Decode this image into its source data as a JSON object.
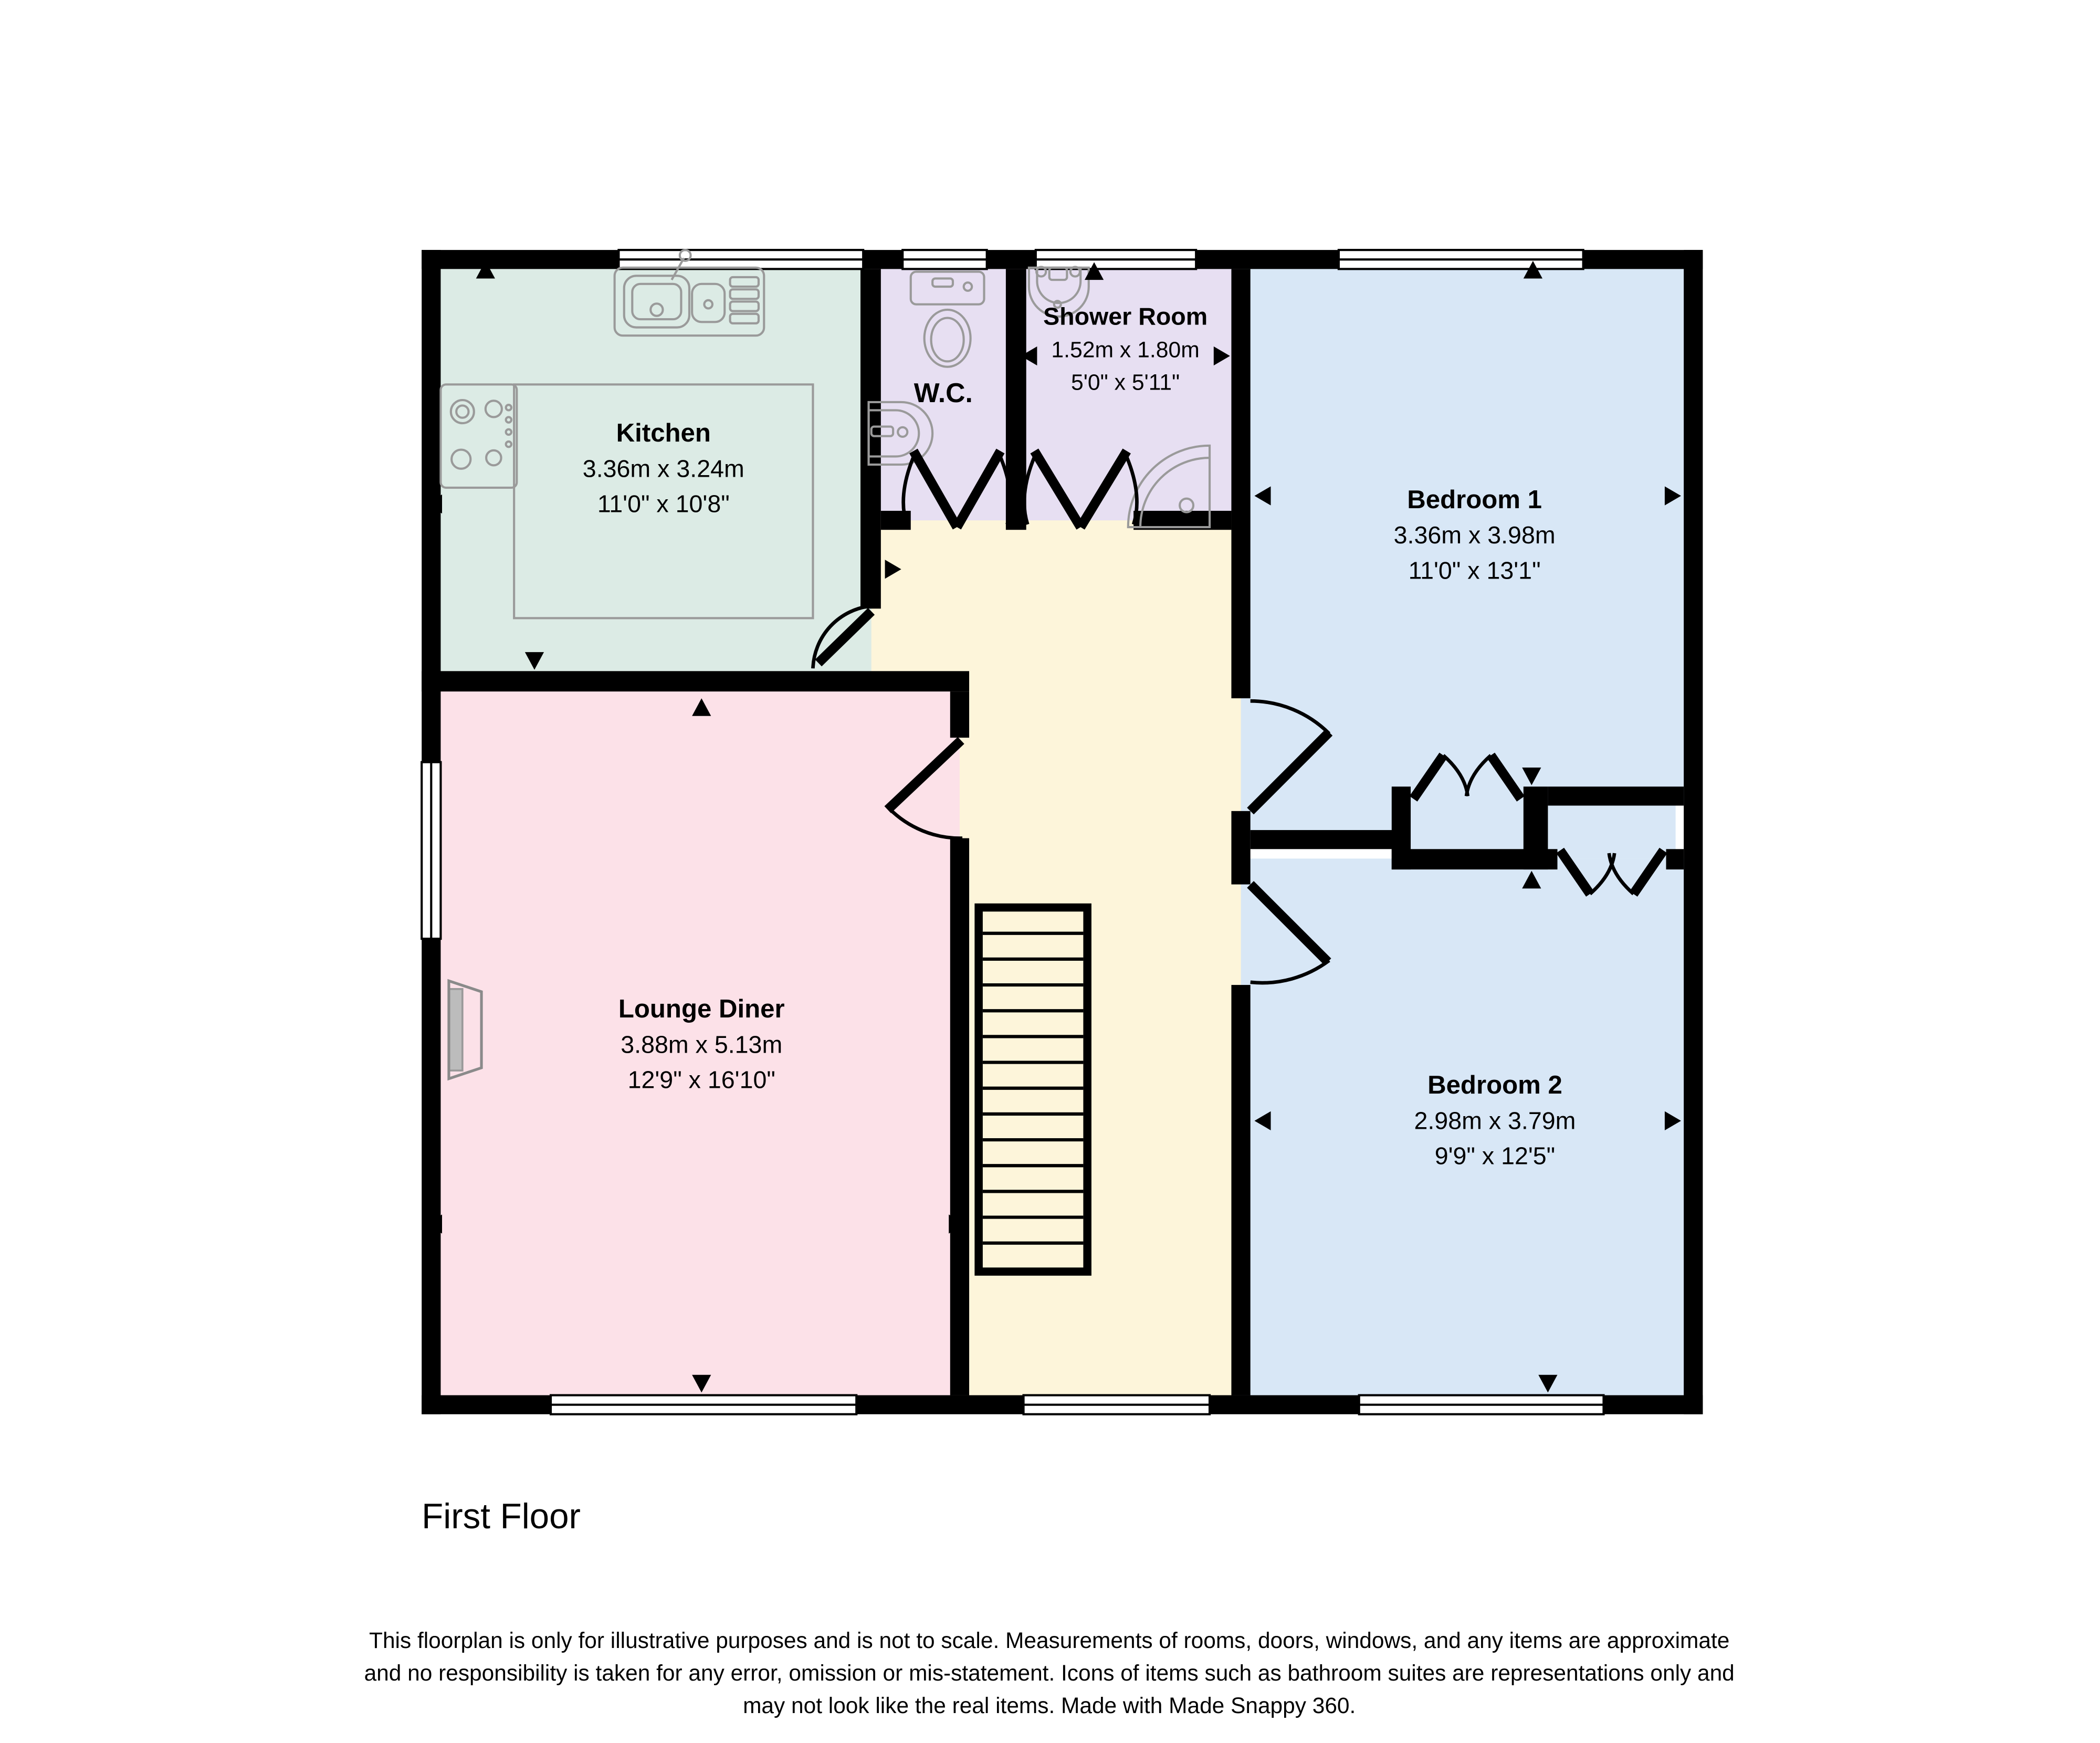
{
  "floor": {
    "title": "First Floor"
  },
  "rooms": {
    "kitchen": {
      "name": "Kitchen",
      "metric": "3.36m x 3.24m",
      "imperial": "11'0\" x 10'8\""
    },
    "wc": {
      "name": "W.C."
    },
    "shower": {
      "name": "Shower Room",
      "metric": "1.52m x 1.80m",
      "imperial": "5'0\" x 5'11\""
    },
    "bedroom1": {
      "name": "Bedroom 1",
      "metric": "3.36m x 3.98m",
      "imperial": "11'0\" x 13'1\""
    },
    "lounge": {
      "name": "Lounge Diner",
      "metric": "3.88m x 5.13m",
      "imperial": "12'9\" x 16'10\""
    },
    "bedroom2": {
      "name": "Bedroom 2",
      "metric": "2.98m x 3.79m",
      "imperial": "9'9\" x 12'5\""
    }
  },
  "disclaimer": {
    "line1": "This floorplan is only for illustrative purposes and is not to scale. Measurements of rooms, doors, windows, and any items are approximate",
    "line2": "and no responsibility is taken for any error, omission or mis-statement. Icons of items such as bathroom suites are representations only and",
    "line3": "may not look like the real items. Made with Made Snappy 360."
  },
  "colors": {
    "kitchen": "#dcebe5",
    "bathroom": "#e7dff2",
    "bedroom": "#d8e7f6",
    "lounge": "#fce1e8",
    "hall": "#fdf5da",
    "wall": "#000000",
    "fixture_stroke": "#9a9a9a"
  },
  "icons": [
    "kitchen-sink-icon",
    "hob-icon",
    "worktop-outline",
    "toilet-icon",
    "wc-basin-icon",
    "shower-basin-icon",
    "shower-tray-icon",
    "fireplace-icon",
    "stairs-icon",
    "door-swing-icon",
    "bifold-door-icon",
    "direction-arrow-icon",
    "window-icon"
  ]
}
